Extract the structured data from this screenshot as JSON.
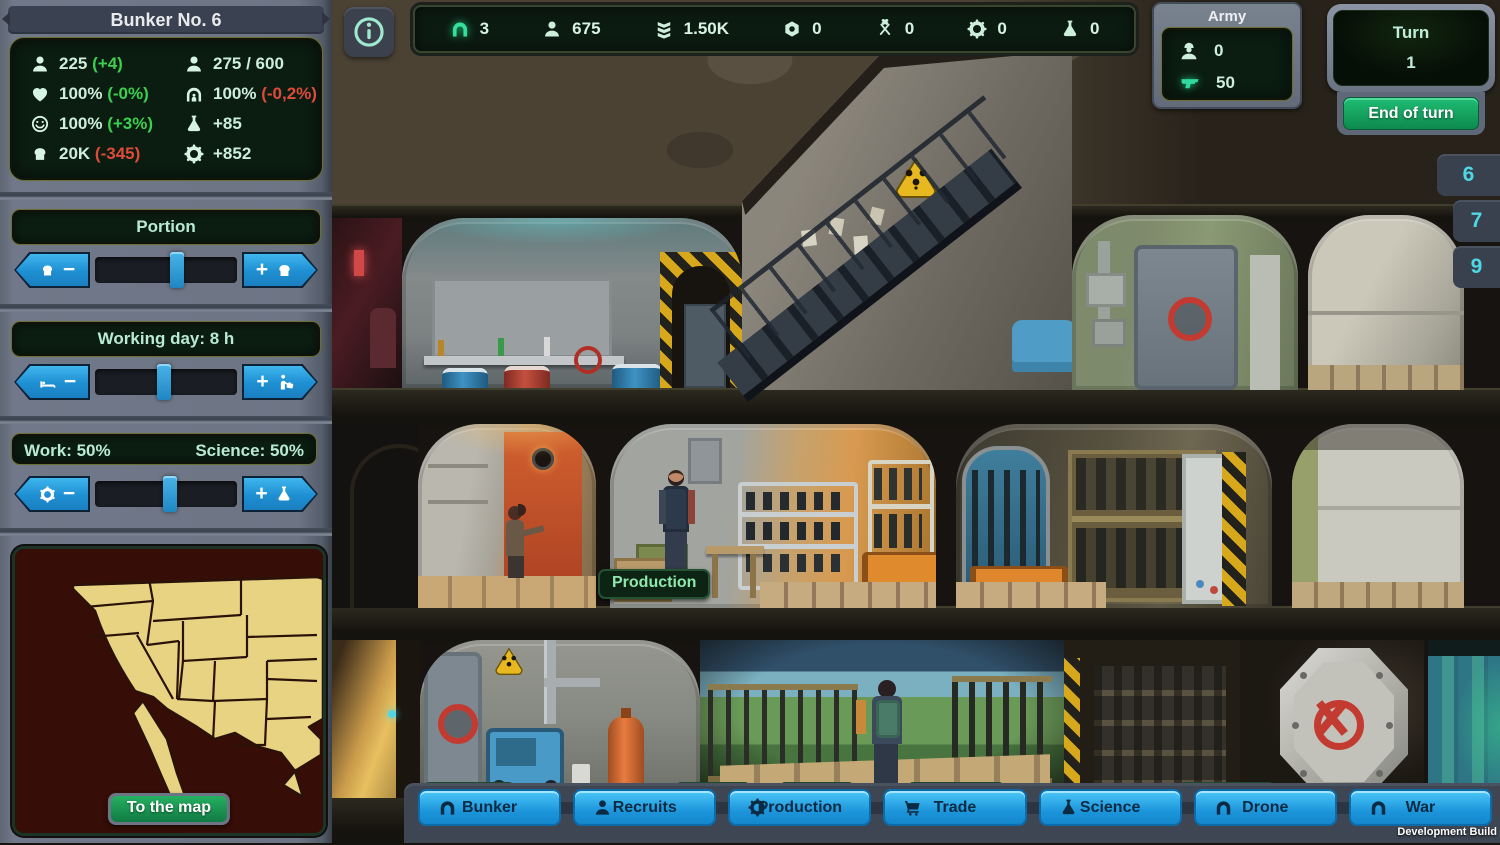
{
  "colors": {
    "accent_blue": "#2ba6e8",
    "screen_text": "#cdeeda",
    "positive": "#3bd04f",
    "negative": "#df4b38",
    "button_green": "#16a85e",
    "tab_cyan": "#4fd8e4",
    "nav_blue": "#29a9e8"
  },
  "header": {
    "title": "Bunker No. 6"
  },
  "stats": {
    "items": [
      {
        "icon": "population-icon",
        "value": "225",
        "delta": "(+4)"
      },
      {
        "icon": "capacity-icon",
        "value": "275 / 600",
        "delta": ""
      },
      {
        "icon": "health-icon",
        "value": "100%",
        "delta": "(-0%)"
      },
      {
        "icon": "shelter-icon",
        "value": "100%",
        "delta": "(-0,2%)"
      },
      {
        "icon": "happiness-icon",
        "value": "100%",
        "delta": "(+3%)"
      },
      {
        "icon": "science-icon",
        "value": "+85",
        "delta": ""
      },
      {
        "icon": "food-icon",
        "value": "20K",
        "delta": "(-345)"
      },
      {
        "icon": "production-icon",
        "value": "+852",
        "delta": ""
      }
    ]
  },
  "ui": {
    "minus": "−",
    "plus": "+"
  },
  "sliders": {
    "portion": {
      "title": "Portion"
    },
    "working_day": {
      "title": "Working day: 8 h"
    },
    "work_science": {
      "left": "Work: 50%",
      "right": "Science: 50%"
    }
  },
  "map": {
    "button_label": "To the map"
  },
  "resource_bar": {
    "items": [
      {
        "icon": "bunker-icon",
        "value": "3"
      },
      {
        "icon": "population-icon",
        "value": "675"
      },
      {
        "icon": "rank-icon",
        "value": "1.50K"
      },
      {
        "icon": "nut-icon",
        "value": "0"
      },
      {
        "icon": "tools-icon",
        "value": "0"
      },
      {
        "icon": "gear-icon",
        "value": "0"
      },
      {
        "icon": "science-icon",
        "value": "0"
      }
    ]
  },
  "army": {
    "title": "Army",
    "soldiers": "0",
    "weapons": "50"
  },
  "turn_panel": {
    "label": "Turn",
    "value": "1",
    "end_button": "End of turn"
  },
  "floor_tabs": {
    "items": [
      "6",
      "7",
      "9"
    ]
  },
  "scene": {
    "production_label": "Production"
  },
  "nav": {
    "items": [
      {
        "icon": "bunker-icon",
        "label": "Bunker"
      },
      {
        "icon": "recruit-icon",
        "label": "Recruits"
      },
      {
        "icon": "gear-icon",
        "label": "Production"
      },
      {
        "icon": "cart-icon",
        "label": "Trade"
      },
      {
        "icon": "science-icon",
        "label": "Science"
      },
      {
        "icon": "bunker-icon",
        "label": "Drone"
      },
      {
        "icon": "bunker-icon",
        "label": "War"
      }
    ]
  },
  "footer": {
    "build_label": "Development Build"
  }
}
